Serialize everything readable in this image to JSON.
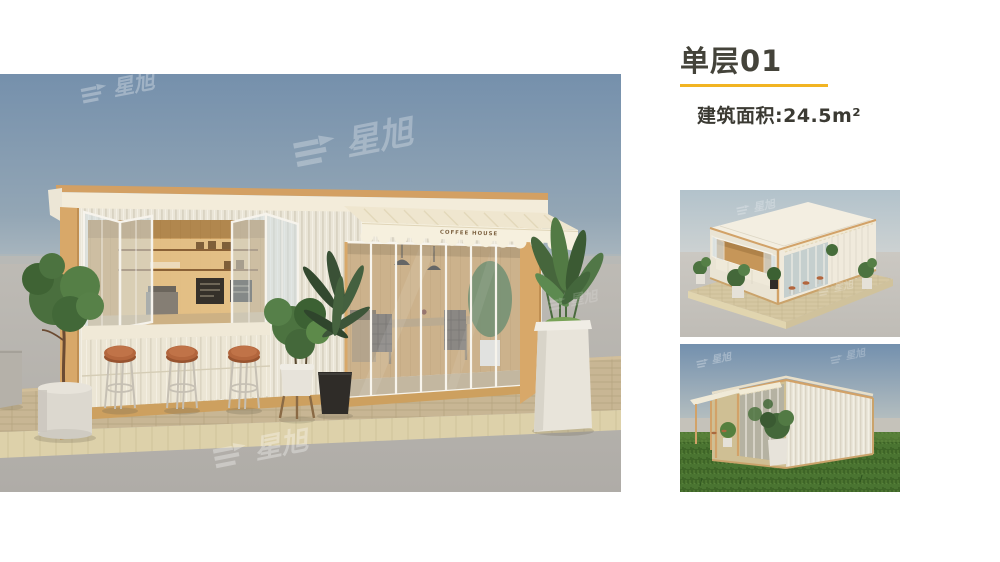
{
  "header": {
    "title": "单层01",
    "area_label": "建筑面积:24.5m²"
  },
  "main_render": {
    "awning_text": "COFFEE HOUSE"
  },
  "watermark": {
    "brand": "星旭"
  },
  "colors": {
    "accent_underline": "#F2B422",
    "heading_text": "#44433A",
    "sky_blue_top": "#7590AC",
    "wood_tan": "#D8A869",
    "awning_cream": "#F3ECD9",
    "stool_terracotta": "#B3663D",
    "grass_green": "#4A7631"
  }
}
